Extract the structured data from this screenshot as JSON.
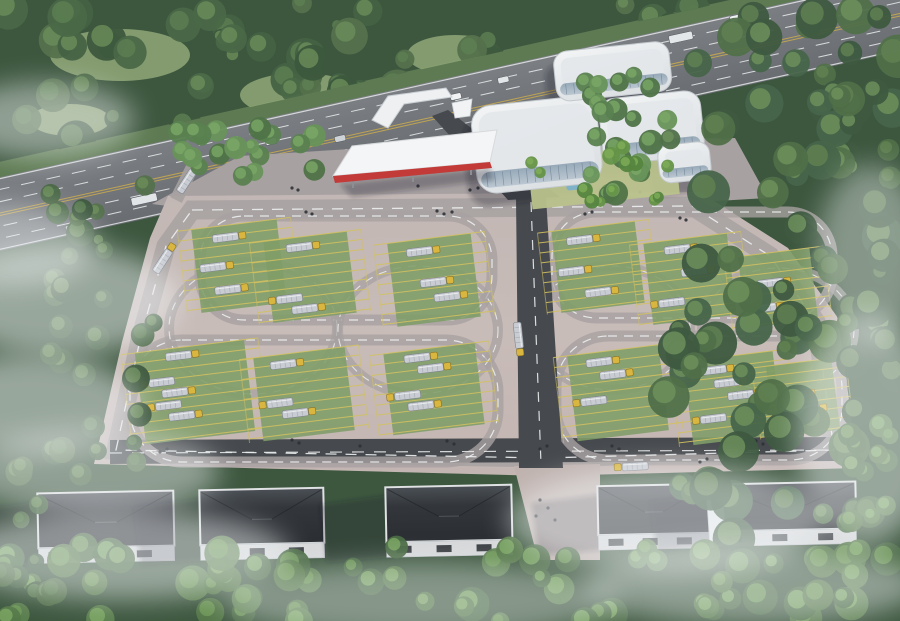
{
  "meta": {
    "description": "Aerial architectural rendering of a truck logistics and driver-training facility",
    "elements": [
      "highway",
      "forest",
      "office-building",
      "entrance-gate",
      "red-canopy",
      "parking-field",
      "truck-stalls",
      "loop-roads",
      "tanker-trucks",
      "warehouses",
      "mist"
    ]
  },
  "palette": {
    "base_forest": "#3d573f",
    "paving": "#c6bab6",
    "paving_low": "#bfb2ae",
    "forecourt": "#a8a1a2",
    "road_grey": "#a7a1a1",
    "road_dark": "#46494d",
    "lane_white": "#eceeef",
    "lane_yellow": "#c9a94f",
    "median_green": "#5d7a52",
    "highway_top": "#797d81",
    "highway_bot": "#6a6e72",
    "stall_green": "#7f9d68",
    "stall_line": "#d2c160",
    "truck_body": "#c9cdd3",
    "truck_rib": "#a9afb6",
    "truck_cab": "#d9b63f",
    "building_white": "#eef0f2",
    "building_roof": "#e3e7ea",
    "building_edge": "#c2c8cd",
    "glass_a": "#7f93a5",
    "glass_b": "#b7c4cf",
    "court_lawn": "#b9c28c",
    "pond": "#7fb2c9",
    "canopy_white": "#f4f5f6",
    "canopy_red": "#c23b38",
    "wh_roof": "#2e3236",
    "wh_roof_hi": "#51575d",
    "wh_wall": "#d6d8da",
    "wh_door": "#3c4044",
    "people": "#2c3136",
    "mist": "#f3f6f8",
    "shadow": "rgba(26,32,40,0.3)"
  },
  "scene": {
    "highway": {
      "angle": -12.5,
      "cx": 450,
      "cy": 105,
      "verge": {
        "x": -90,
        "y": 63,
        "w": 1180,
        "h": 16
      },
      "road": {
        "x": -90,
        "y": 78,
        "w": 1180,
        "h": 72
      },
      "solid_lines": [
        79.5,
        148.5
      ],
      "dashed_lines": [
        90,
        102,
        126,
        138
      ],
      "yellow_lines": [
        113,
        115.5
      ],
      "vehicles": [
        {
          "x": 48,
          "y": 140,
          "w": 18,
          "h": 7,
          "c": "#c3c8cc"
        },
        {
          "x": 118,
          "y": 127,
          "w": 26,
          "h": 8,
          "c": "#e2e5e8"
        },
        {
          "x": 166,
          "y": 142,
          "w": 10,
          "h": 6,
          "c": "#d9ba41"
        },
        {
          "x": 205,
          "y": 130,
          "w": 11,
          "h": 6,
          "c": "#f1f3f4"
        },
        {
          "x": 262,
          "y": 99,
          "w": 11,
          "h": 6,
          "c": "#eceef0"
        },
        {
          "x": 330,
          "y": 111,
          "w": 11,
          "h": 6,
          "c": "#ced3d7"
        },
        {
          "x": 348,
          "y": 130,
          "w": 11,
          "h": 6,
          "c": "#e8ebed"
        },
        {
          "x": 404,
          "y": 84,
          "w": 11,
          "h": 6,
          "c": "#edeff1"
        },
        {
          "x": 452,
          "y": 95,
          "w": 11,
          "h": 6,
          "c": "#f0f2f3"
        },
        {
          "x": 502,
          "y": 89,
          "w": 11,
          "h": 6,
          "c": "#e3e6e9"
        },
        {
          "x": 586,
          "y": 95,
          "w": 11,
          "h": 6,
          "c": "#eef0f2"
        },
        {
          "x": 608,
          "y": 108,
          "w": 11,
          "h": 6,
          "c": "#b03a35"
        },
        {
          "x": 678,
          "y": 85,
          "w": 24,
          "h": 8,
          "c": "#e4e7ea"
        },
        {
          "x": 742,
          "y": 79,
          "w": 11,
          "h": 6,
          "c": "#f0f2f4"
        }
      ]
    },
    "meadows": [
      {
        "x": 120,
        "y": 55,
        "rx": 70,
        "ry": 26
      },
      {
        "x": 300,
        "y": 95,
        "rx": 60,
        "ry": 22
      },
      {
        "x": 455,
        "y": 55,
        "rx": 48,
        "ry": 20
      },
      {
        "x": 560,
        "y": 118,
        "rx": 40,
        "ry": 16
      },
      {
        "x": 70,
        "y": 120,
        "rx": 40,
        "ry": 16
      }
    ],
    "forecourt": [
      [
        152,
        204
      ],
      [
        240,
        156
      ],
      [
        460,
        142
      ],
      [
        735,
        138
      ],
      [
        768,
        198
      ],
      [
        700,
        202
      ],
      [
        168,
        206
      ]
    ],
    "site": {
      "ground": [
        [
          168,
          196
        ],
        [
          700,
          192
        ],
        [
          788,
          248
        ],
        [
          838,
          318
        ],
        [
          858,
          468
        ],
        [
          545,
          476
        ],
        [
          94,
          464
        ],
        [
          122,
          342
        ],
        [
          150,
          238
        ]
      ],
      "perimeter": [
        [
          192,
          210
        ],
        [
          692,
          206
        ],
        [
          770,
          256
        ],
        [
          816,
          322
        ],
        [
          834,
          450
        ],
        [
          545,
          458
        ],
        [
          116,
          450
        ],
        [
          140,
          340
        ],
        [
          166,
          246
        ]
      ],
      "left_spur": {
        "x1": 176,
        "y1": 200,
        "x2": 196,
        "y2": 160
      },
      "bottom_dark": {
        "x1": 110,
        "y1": 452,
        "x2": 838,
        "y2": 449
      },
      "center_road": [
        [
          516,
          197
        ],
        [
          546,
          197
        ],
        [
          563,
          468
        ],
        [
          519,
          468
        ]
      ],
      "entry_road": [
        [
          432,
          116
        ],
        [
          448,
          110
        ],
        [
          560,
          197
        ],
        [
          508,
          200
        ]
      ],
      "gap_pave": [
        [
          514,
          466
        ],
        [
          600,
          464
        ],
        [
          600,
          560
        ],
        [
          538,
          560
        ]
      ],
      "loops": [
        {
          "x": 200,
          "y": 216,
          "w": 292,
          "h": 104,
          "r": 44
        },
        {
          "x": 552,
          "y": 212,
          "w": 280,
          "h": 106,
          "r": 44
        },
        {
          "x": 130,
          "y": 340,
          "w": 368,
          "h": 122,
          "r": 52
        },
        {
          "x": 556,
          "y": 336,
          "w": 286,
          "h": 124,
          "r": 52
        }
      ],
      "circles": [
        {
          "cx": 253,
          "cy": 328,
          "rx": 84,
          "ry": 66
        },
        {
          "cx": 418,
          "cy": 330,
          "rx": 80,
          "ry": 64
        },
        {
          "cx": 612,
          "cy": 328,
          "rx": 78,
          "ry": 62
        },
        {
          "cx": 778,
          "cy": 330,
          "rx": 76,
          "ry": 62
        }
      ]
    },
    "clusters": [
      {
        "x": 196,
        "y": 224,
        "w": 86,
        "h": 84,
        "trucks": [
          [
            20,
            8,
            0
          ],
          [
            4,
            36,
            0
          ],
          [
            16,
            60,
            0
          ]
        ]
      },
      {
        "x": 268,
        "y": 236,
        "w": 84,
        "h": 82,
        "trucks": [
          [
            22,
            6,
            0
          ],
          [
            6,
            56,
            1
          ],
          [
            20,
            68,
            0
          ]
        ]
      },
      {
        "x": 392,
        "y": 238,
        "w": 84,
        "h": 84,
        "trucks": [
          [
            18,
            8,
            0
          ],
          [
            28,
            40,
            0
          ],
          [
            40,
            56,
            0
          ]
        ]
      },
      {
        "x": 556,
        "y": 226,
        "w": 84,
        "h": 82,
        "trucks": [
          [
            14,
            8,
            0
          ],
          [
            2,
            38,
            0
          ],
          [
            26,
            62,
            0
          ]
        ]
      },
      {
        "x": 648,
        "y": 238,
        "w": 84,
        "h": 82,
        "trucks": [
          [
            20,
            6,
            0
          ],
          [
            34,
            30,
            0
          ],
          [
            8,
            58,
            1
          ]
        ]
      },
      {
        "x": 742,
        "y": 252,
        "w": 72,
        "h": 72,
        "trucks": [
          [
            16,
            26,
            0
          ],
          [
            6,
            50,
            0
          ]
        ]
      },
      {
        "x": 140,
        "y": 346,
        "w": 110,
        "h": 92,
        "trucks": [
          [
            30,
            4,
            0
          ],
          [
            10,
            28,
            1
          ],
          [
            22,
            40,
            0
          ],
          [
            14,
            52,
            1
          ],
          [
            26,
            64,
            0
          ]
        ]
      },
      {
        "x": 258,
        "y": 352,
        "w": 92,
        "h": 84,
        "trucks": [
          [
            16,
            6,
            0
          ],
          [
            8,
            44,
            1
          ],
          [
            22,
            56,
            0
          ]
        ]
      },
      {
        "x": 388,
        "y": 348,
        "w": 92,
        "h": 82,
        "trucks": [
          [
            20,
            4,
            0
          ],
          [
            32,
            16,
            0
          ],
          [
            6,
            40,
            1
          ],
          [
            18,
            52,
            0
          ]
        ]
      },
      {
        "x": 572,
        "y": 350,
        "w": 92,
        "h": 86,
        "trucks": [
          [
            18,
            6,
            0
          ],
          [
            30,
            20,
            0
          ],
          [
            8,
            44,
            1
          ]
        ]
      },
      {
        "x": 688,
        "y": 356,
        "w": 90,
        "h": 84,
        "trucks": [
          [
            16,
            8,
            0
          ],
          [
            28,
            22,
            0
          ],
          [
            40,
            36,
            0
          ],
          [
            10,
            56,
            1
          ]
        ]
      },
      {
        "x": 770,
        "y": 362,
        "w": 66,
        "h": 72,
        "trucks": [
          [
            12,
            28,
            0
          ],
          [
            22,
            44,
            0
          ]
        ]
      }
    ],
    "road_trucks": [
      {
        "x": 152,
        "y": 270,
        "rot": -57,
        "flip": 0
      },
      {
        "x": 176,
        "y": 190,
        "rot": -57,
        "flip": 0
      },
      {
        "x": 521,
        "y": 322,
        "rot": 84,
        "flip": 0
      },
      {
        "x": 622,
        "y": 463,
        "rot": -3,
        "flip": 1
      }
    ],
    "building": {
      "rot": -6,
      "rcx": 580,
      "rcy": 125,
      "court": {
        "x": 524,
        "y": 148,
        "w": 148,
        "h": 56
      },
      "pond": {
        "x": 560,
        "y": 180,
        "w": 24,
        "h": 9
      },
      "wings": [
        {
          "x": 472,
          "y": 96,
          "w": 126,
          "h": 88,
          "rx": 20,
          "band": [
            476,
            162,
            118,
            16,
            9
          ]
        },
        {
          "x": 560,
          "y": 50,
          "w": 116,
          "h": 50,
          "rx": 14,
          "band": [
            564,
            82,
            108,
            12,
            6
          ]
        },
        {
          "x": 600,
          "y": 102,
          "w": 102,
          "h": 66,
          "rx": 16,
          "band": [
            604,
            148,
            94,
            14,
            7
          ]
        },
        {
          "x": 654,
          "y": 154,
          "w": 52,
          "h": 38,
          "rx": 12,
          "band": [
            657,
            178,
            46,
            9,
            5
          ]
        }
      ]
    },
    "canopy": {
      "top": [
        [
          333,
          176
        ],
        [
          352,
          146
        ],
        [
          497,
          130
        ],
        [
          490,
          162
        ]
      ],
      "fascia": [
        [
          333,
          176
        ],
        [
          490,
          162
        ],
        [
          492,
          168
        ],
        [
          335,
          183
        ]
      ],
      "shade": [
        [
          340,
          184
        ],
        [
          490,
          168
        ],
        [
          494,
          180
        ],
        [
          352,
          197
        ]
      ],
      "posts": [
        [
          352,
          178
        ],
        [
          412,
          172
        ],
        [
          470,
          165
        ]
      ]
    },
    "gate": {
      "arch": [
        [
          372,
          120
        ],
        [
          388,
          96
        ],
        [
          446,
          88
        ],
        [
          452,
          97
        ],
        [
          404,
          104
        ],
        [
          388,
          128
        ]
      ],
      "kiosk": [
        [
          452,
          103
        ],
        [
          472,
          99
        ],
        [
          470,
          116
        ],
        [
          455,
          118
        ]
      ]
    },
    "warehouses": [
      {
        "x": 38,
        "y": 492,
        "w": 136,
        "h": 70
      },
      {
        "x": 200,
        "y": 489,
        "w": 124,
        "h": 70
      },
      {
        "x": 386,
        "y": 486,
        "w": 126,
        "h": 70
      },
      {
        "x": 598,
        "y": 485,
        "w": 112,
        "h": 64
      },
      {
        "x": 716,
        "y": 483,
        "w": 140,
        "h": 62
      }
    ],
    "ramp": [
      [
        706,
        486
      ],
      [
        722,
        484
      ],
      [
        726,
        545
      ],
      [
        710,
        548
      ]
    ],
    "tree_regions": [
      {
        "x": 0,
        "y": 0,
        "w": 710,
        "h": 160,
        "n": 85,
        "rmin": 9,
        "rmax": 20,
        "pal": "top",
        "clip": "clipTop",
        "seed": 7
      },
      {
        "x": 175,
        "y": 128,
        "w": 165,
        "h": 52,
        "n": 20,
        "rmin": 7,
        "rmax": 12,
        "pal": "band",
        "seed": 11
      },
      {
        "x": 585,
        "y": 70,
        "w": 85,
        "h": 135,
        "n": 22,
        "rmin": 8,
        "rmax": 13,
        "pal": "band",
        "seed": 13
      },
      {
        "x": 668,
        "y": 0,
        "w": 232,
        "h": 555,
        "n": 95,
        "rmin": 10,
        "rmax": 22,
        "pal": "right",
        "seed": 17
      },
      {
        "x": 48,
        "y": 185,
        "w": 112,
        "h": 290,
        "n": 30,
        "rmin": 8,
        "rmax": 15,
        "pal": "top",
        "seed": 19
      },
      {
        "x": 0,
        "y": 542,
        "w": 900,
        "h": 80,
        "n": 70,
        "rmin": 9,
        "rmax": 18,
        "pal": "bottom",
        "seed": 23
      },
      {
        "x": 845,
        "y": 425,
        "w": 55,
        "h": 130,
        "n": 12,
        "rmin": 8,
        "rmax": 14,
        "pal": "bottom",
        "seed": 29
      },
      {
        "x": 0,
        "y": 460,
        "w": 55,
        "h": 160,
        "n": 10,
        "rmin": 8,
        "rmax": 14,
        "pal": "top",
        "seed": 31
      },
      {
        "x": 524,
        "y": 146,
        "w": 148,
        "h": 56,
        "n": 13,
        "rmin": 5,
        "rmax": 9,
        "pal": "court",
        "seed": 37
      }
    ],
    "palettes": {
      "top": {
        "base": [
          "#3c573d",
          "#456243",
          "#4a6847",
          "#54714c"
        ],
        "light": [
          "#5e7f52",
          "#6b8d5a"
        ]
      },
      "band": {
        "base": [
          "#4f7347",
          "#5a8150",
          "#68935a"
        ],
        "light": [
          "#7aa766"
        ]
      },
      "right": {
        "base": [
          "#3e5a40",
          "#47654a",
          "#507049"
        ],
        "light": [
          "#618253",
          "#6f925d"
        ]
      },
      "bottom": {
        "base": [
          "#4a6a44",
          "#557849",
          "#5d8150"
        ],
        "light": [
          "#6f9a58",
          "#7ca863"
        ]
      },
      "court": {
        "base": [
          "#55853f",
          "#659448"
        ],
        "light": [
          "#7fae57"
        ]
      }
    },
    "people": [
      [
        306,
        212
      ],
      [
        312,
        214
      ],
      [
        437,
        211
      ],
      [
        444,
        214
      ],
      [
        452,
        212
      ],
      [
        585,
        214
      ],
      [
        592,
        212
      ],
      [
        680,
        218
      ],
      [
        686,
        220
      ],
      [
        160,
        452
      ],
      [
        167,
        449
      ],
      [
        292,
        440
      ],
      [
        299,
        443
      ],
      [
        360,
        446
      ],
      [
        447,
        441
      ],
      [
        454,
        444
      ],
      [
        540,
        449
      ],
      [
        547,
        446
      ],
      [
        612,
        446
      ],
      [
        619,
        449
      ],
      [
        700,
        462
      ],
      [
        707,
        459
      ],
      [
        756,
        441
      ],
      [
        763,
        444
      ],
      [
        540,
        500
      ],
      [
        548,
        508
      ],
      [
        536,
        516
      ],
      [
        555,
        520
      ],
      [
        292,
        188
      ],
      [
        298,
        190
      ],
      [
        418,
        186
      ],
      [
        470,
        190
      ],
      [
        478,
        188
      ],
      [
        600,
        190
      ],
      [
        640,
        192
      ],
      [
        250,
        178
      ]
    ],
    "mist": [
      [
        60,
        300,
        120,
        55,
        0.5
      ],
      [
        30,
        405,
        110,
        50,
        0.5
      ],
      [
        90,
        472,
        130,
        42,
        0.45
      ],
      [
        12,
        245,
        85,
        40,
        0.45
      ],
      [
        120,
        555,
        170,
        45,
        0.5
      ],
      [
        420,
        600,
        200,
        38,
        0.4
      ],
      [
        668,
        520,
        160,
        55,
        0.5
      ],
      [
        752,
        585,
        170,
        40,
        0.45
      ],
      [
        866,
        430,
        70,
        115,
        0.5
      ],
      [
        872,
        255,
        55,
        90,
        0.4
      ],
      [
        45,
        120,
        90,
        38,
        0.45
      ]
    ]
  }
}
